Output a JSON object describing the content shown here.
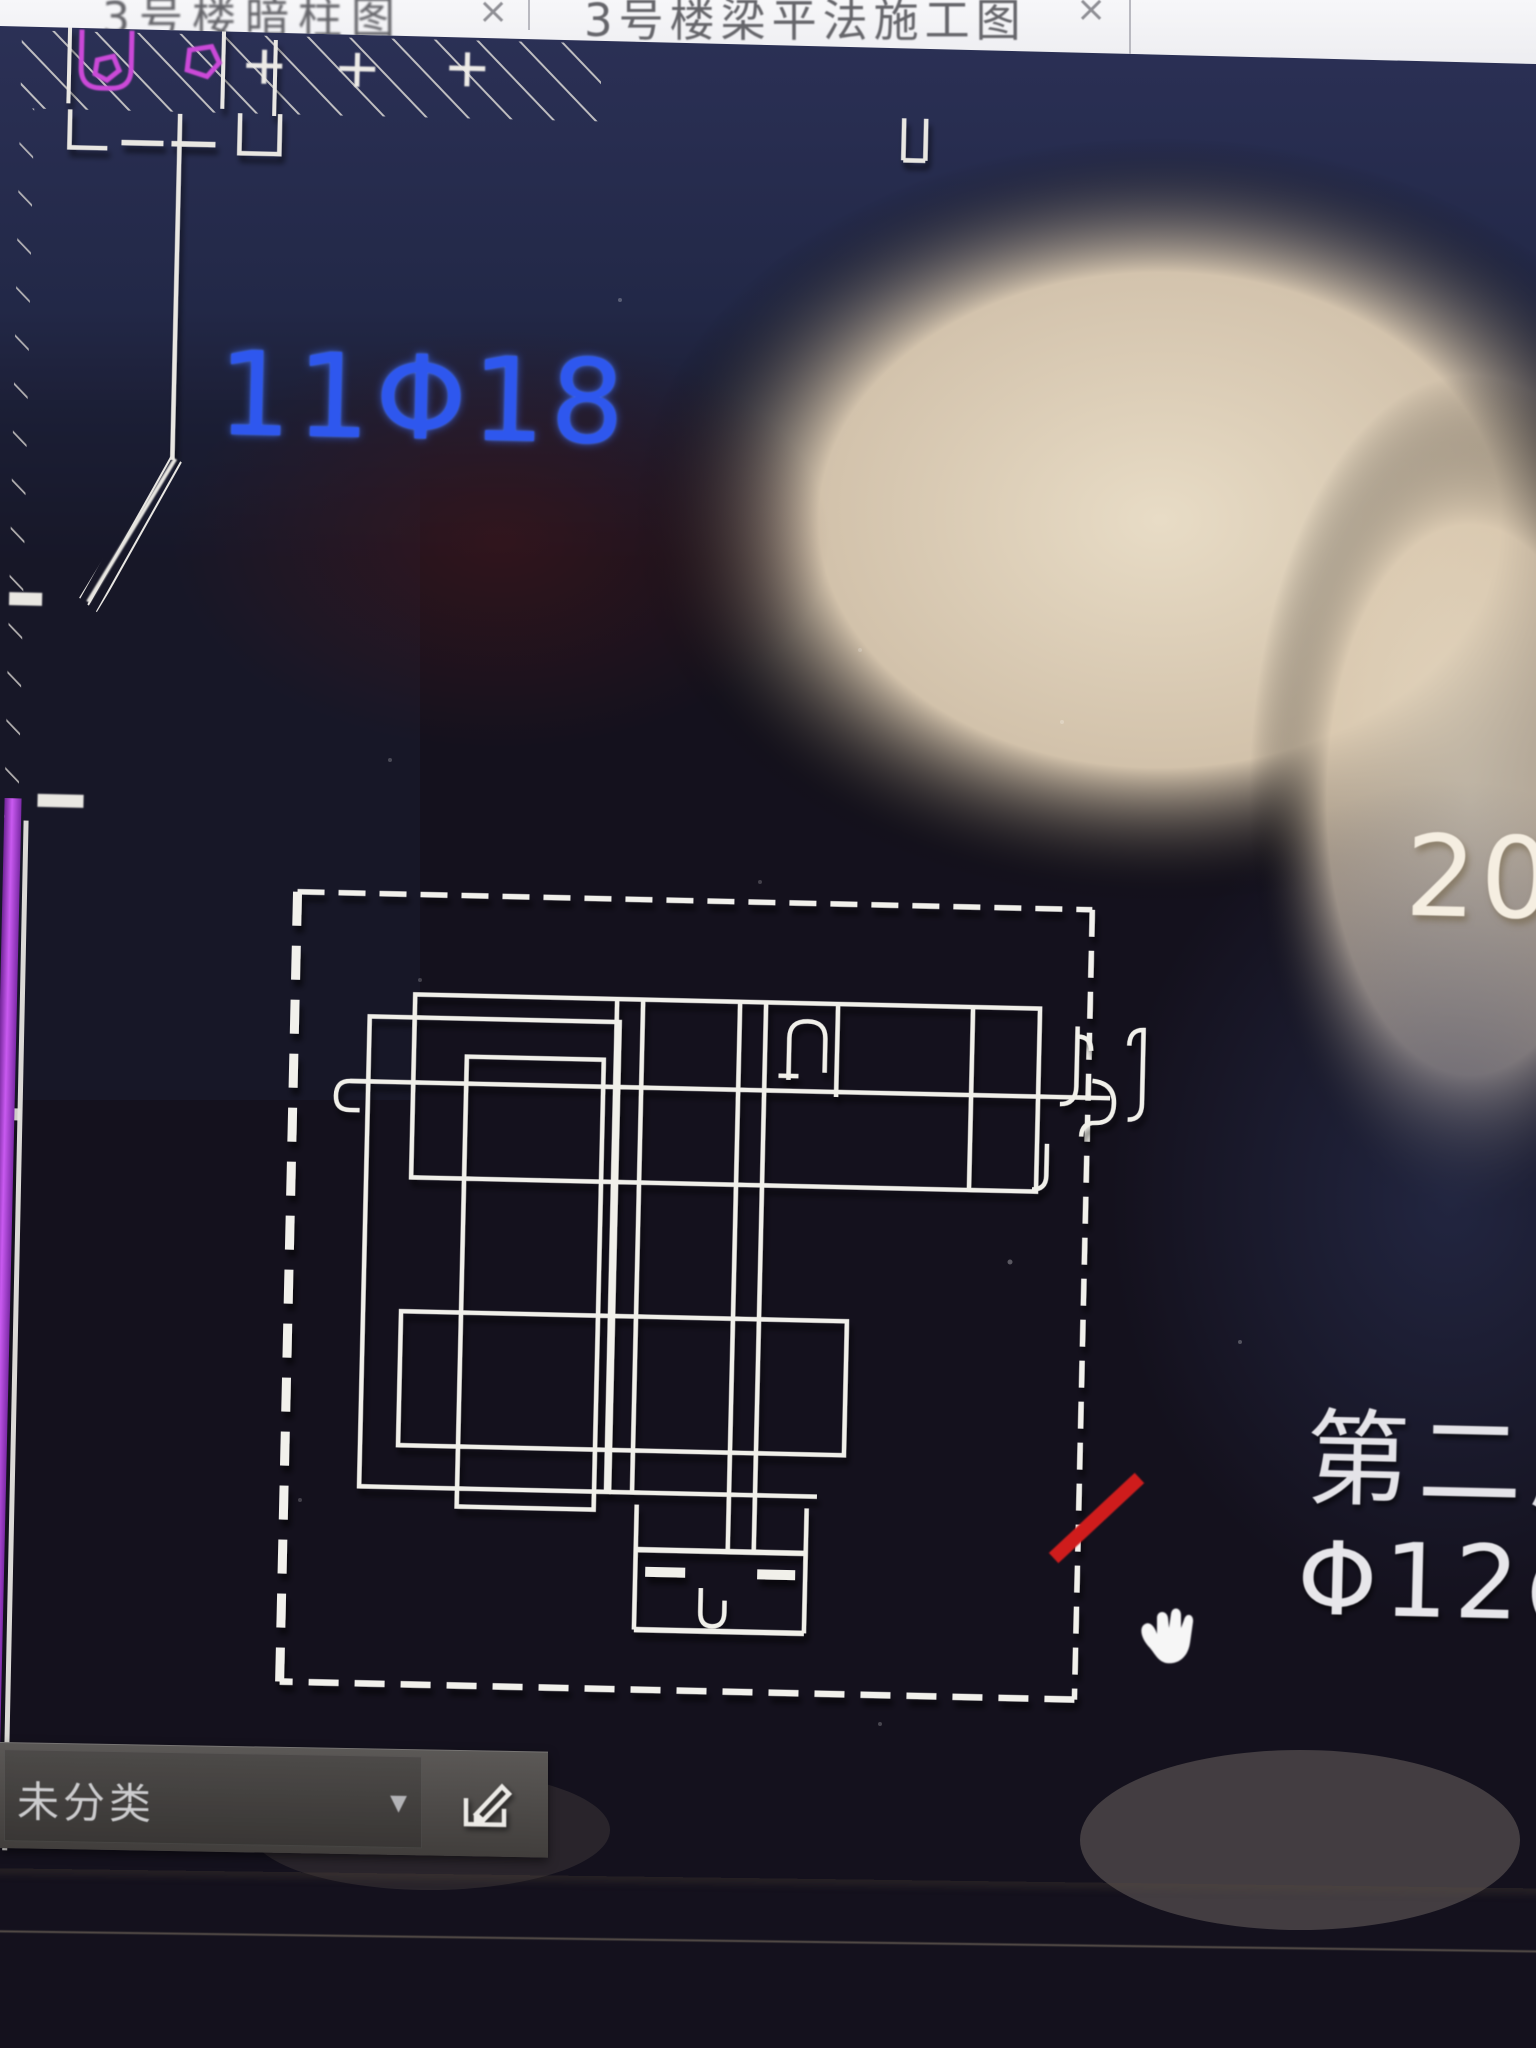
{
  "window": {
    "tabs": [
      {
        "label": "3号楼暗柱图",
        "close_label": "×"
      },
      {
        "label": "3号楼梁平法施工图",
        "close_label": "×"
      }
    ]
  },
  "canvas": {
    "labels": {
      "rebar_count_label": "11Φ18",
      "top_right_label": "20-",
      "note_line1": "第二层",
      "note_line2": "Φ12@"
    }
  },
  "bottom_bar": {
    "category_value": "未分类",
    "dropdown_arrow": "▼"
  },
  "colors": {
    "rebar_label_blue": "#2e57ee",
    "cad_line_white": "#f1f0ea",
    "axis_magenta": "#cb4ad8",
    "left_stripe_purple": "#9a35cc",
    "revision_mark_red": "#cf1f1f",
    "canvas_navy": "#2b3156",
    "reflection_beige": "#e3d4bd"
  }
}
